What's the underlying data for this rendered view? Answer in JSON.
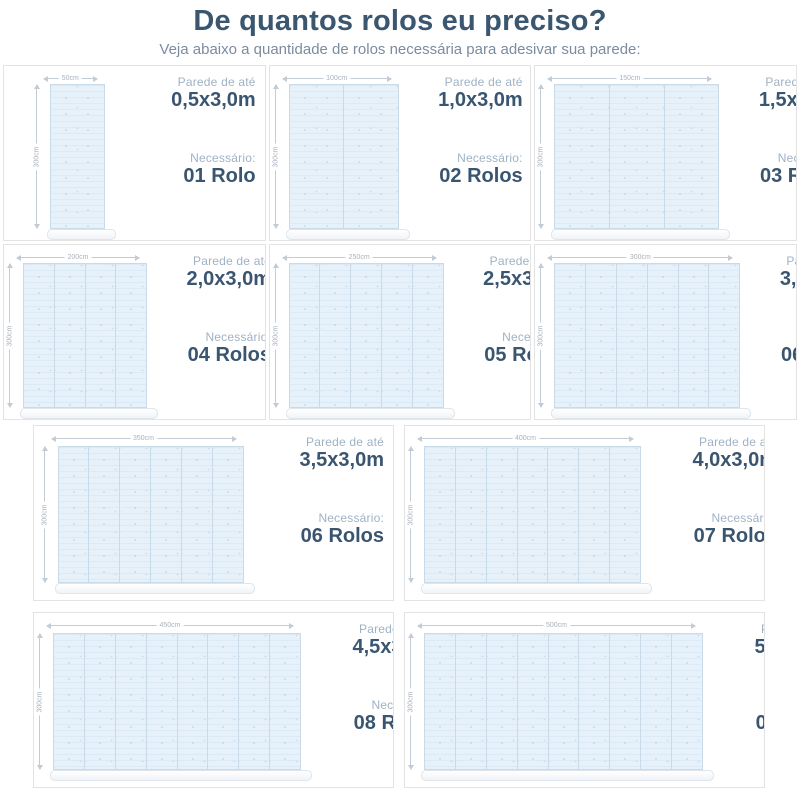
{
  "header": {
    "title": "De quantos rolos eu preciso?",
    "subtitle": "Veja abaixo a quantidade de rolos necessária para adesivar sua parede:"
  },
  "labels": {
    "wall_label": "Parede de até",
    "needed_label": "Necessário:"
  },
  "colors": {
    "title": "#3b566f",
    "subtitle": "#7b8ca1",
    "label": "#9fb2c4",
    "value": "#3a5570",
    "wall_fill": "#e6f1fa",
    "wall_line": "#c9dbe9",
    "panel_border": "#e3e3e3"
  },
  "rows": [
    {
      "panels": [
        {
          "size": "0,5x3,0m",
          "rolls": "01 Rolo",
          "width_label": "50cm",
          "height_label": "300cm",
          "strips": 1
        },
        {
          "size": "1,0x3,0m",
          "rolls": "02 Rolos",
          "width_label": "100cm",
          "height_label": "300cm",
          "strips": 2
        },
        {
          "size": "1,5x3,0m",
          "rolls": "03 Rolos",
          "width_label": "150cm",
          "height_label": "300cm",
          "strips": 3
        }
      ]
    },
    {
      "panels": [
        {
          "size": "2,0x3,0m",
          "rolls": "04 Rolos",
          "width_label": "200cm",
          "height_label": "300cm",
          "strips": 4
        },
        {
          "size": "2,5x3,0m",
          "rolls": "05 Rolos",
          "width_label": "250cm",
          "height_label": "300cm",
          "strips": 5
        },
        {
          "size": "3,0x3,0m",
          "rolls": "06 Rolos",
          "width_label": "300cm",
          "height_label": "300cm",
          "strips": 6
        }
      ]
    },
    {
      "panels": [
        {
          "size": "3,5x3,0m",
          "rolls": "06 Rolos",
          "width_label": "350cm",
          "height_label": "300cm",
          "strips": 6
        },
        {
          "size": "4,0x3,0m",
          "rolls": "07 Rolos",
          "width_label": "400cm",
          "height_label": "300cm",
          "strips": 7
        }
      ]
    },
    {
      "panels": [
        {
          "size": "4,5x3,0m",
          "rolls": "08 Rolos",
          "width_label": "450cm",
          "height_label": "300cm",
          "strips": 8
        },
        {
          "size": "5,0x3,0m",
          "rolls": "09 Rolos",
          "width_label": "500cm",
          "height_label": "300cm",
          "strips": 9
        }
      ]
    }
  ]
}
